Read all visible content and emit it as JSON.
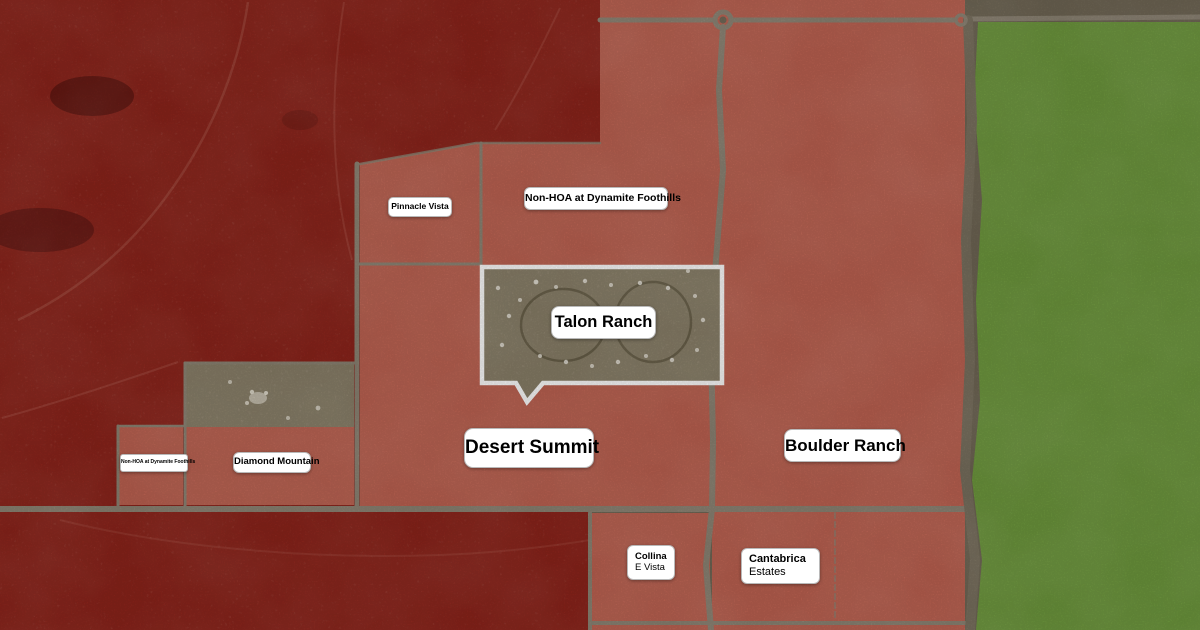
{
  "map": {
    "title": "HOA communities satellite overlay map",
    "colors": {
      "overlay_dark_red": "#8e241b",
      "overlay_salmon": "#bf6352",
      "open_space_green": "#6f9a3e",
      "road": "#8d8474",
      "road_dark": "#79705e",
      "satellite_ground": "#6f6654",
      "satellite_parcel": "#8a8069",
      "boundary_white": "#ffffff",
      "label_background": "#ffffff",
      "label_text": "#000000"
    },
    "labels": {
      "pinnacle_vista": "Pinnacle Vista",
      "non_hoa_dynamite": "Non-HOA at Dynamite Foothills",
      "talon_ranch": "Talon Ranch",
      "desert_summit": "Desert Summit",
      "boulder_ranch": "Boulder Ranch",
      "diamond_mountain": "Diamond Mountain",
      "non_hoa_dynamite_small": "Non-HOA at Dynamite Foothills",
      "collina_line1": "Collina",
      "collina_line2": "E Vista",
      "cantabrica_line1": "Cantabrica",
      "cantabrica_line2": "Estates"
    }
  }
}
